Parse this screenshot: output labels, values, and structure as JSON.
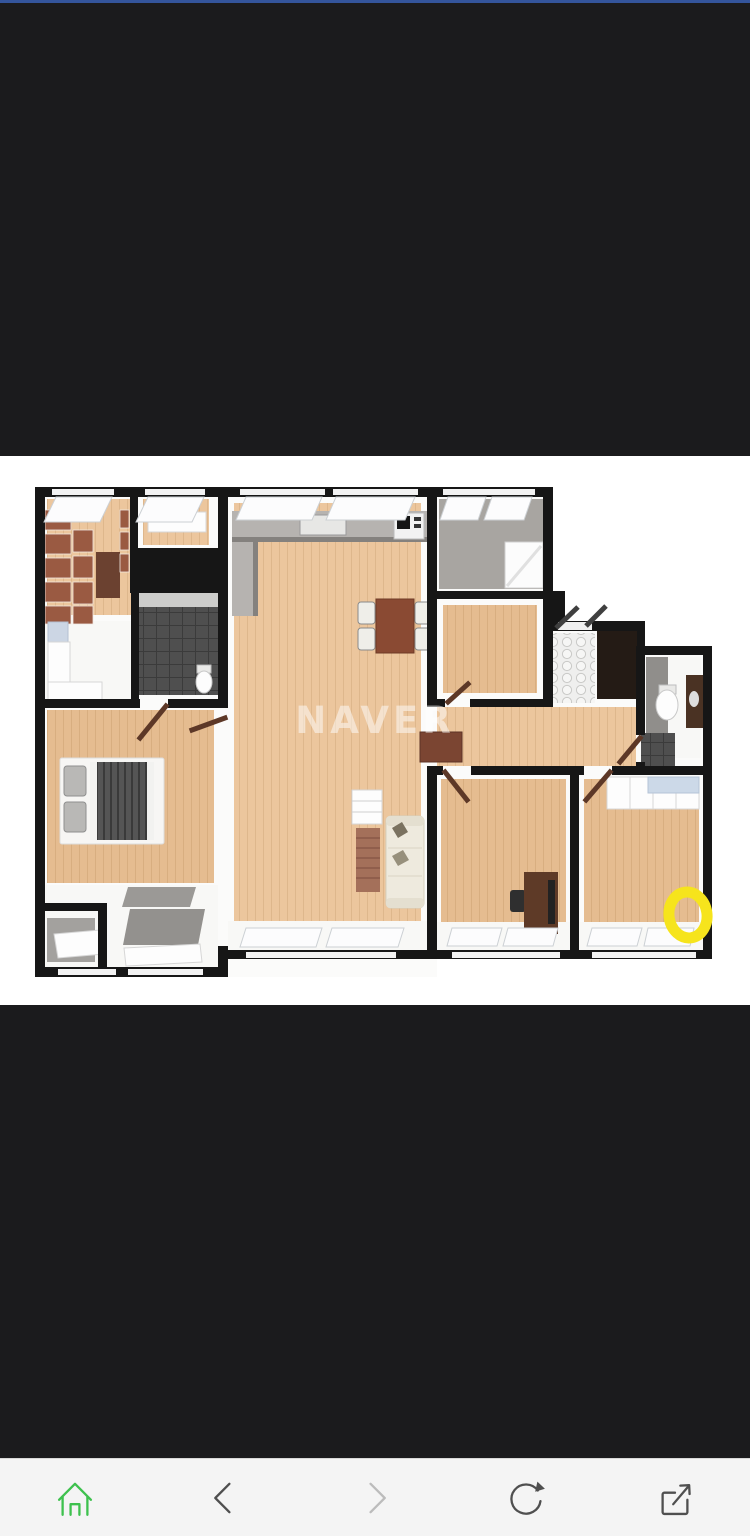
{
  "colors": {
    "status_bar_blue": "#34559c",
    "letterbox_black": "#1b1b1d",
    "canvas_white": "#ffffff",
    "toolbar_bg": "#f4f4f4",
    "toolbar_border": "#d8d8d8",
    "icon_dark": "#4f4f4f",
    "icon_disabled": "#bcbcbc",
    "naver_green": "#3ec14e",
    "marker_yellow": "#f6e41c",
    "wall_black": "#161616",
    "floor_wood": "#ecc69d",
    "floor_wood_dark": "#e5bc90",
    "tile_grey": "#a8a5a1",
    "tile_dark": "#4f4f4f",
    "watermark_white": "#ffffff"
  },
  "floorplan": {
    "type": "3d-rendered apartment floor plan, top-down",
    "watermark": "NAVER",
    "annotation": "hand-drawn yellow circle highlight, bottom-right bedroom"
  },
  "toolbar": {
    "items": [
      {
        "name": "home",
        "icon": "home-icon",
        "disabled": false
      },
      {
        "name": "back",
        "icon": "chevron-left-icon",
        "disabled": false
      },
      {
        "name": "forward",
        "icon": "chevron-right-icon",
        "disabled": true
      },
      {
        "name": "refresh",
        "icon": "refresh-icon",
        "disabled": false
      },
      {
        "name": "share",
        "icon": "share-icon",
        "disabled": false
      }
    ]
  }
}
